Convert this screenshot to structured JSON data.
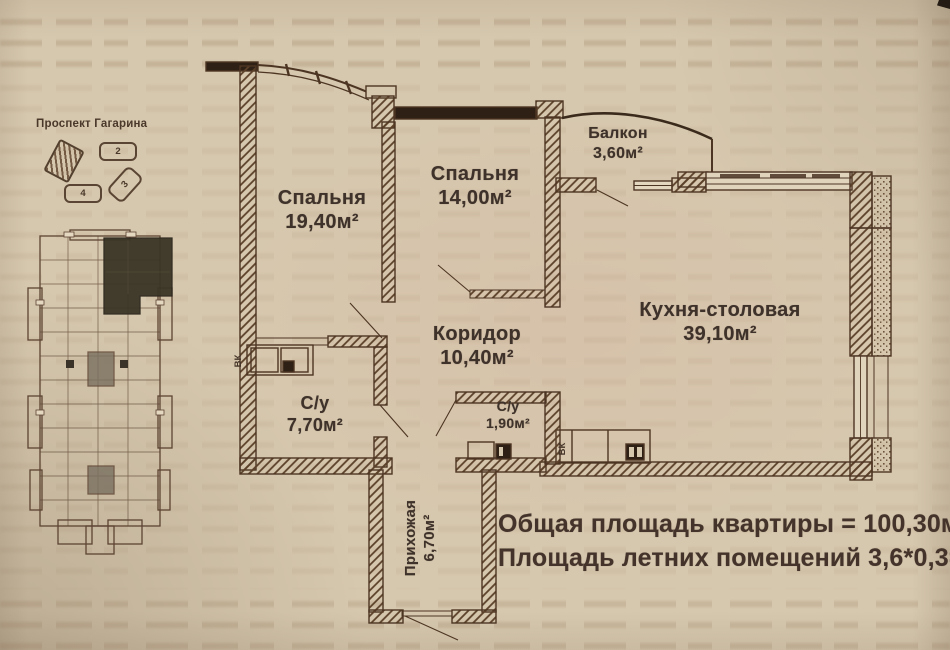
{
  "site": {
    "street_label": "Проспект Гагарина",
    "blocks": [
      {
        "num": "2"
      },
      {
        "num": "3"
      },
      {
        "num": "4"
      }
    ]
  },
  "rooms": {
    "bedroom1": {
      "name": "Спальня",
      "area": "19,40м²"
    },
    "bedroom2": {
      "name": "Спальня",
      "area": "14,00м²"
    },
    "balcony": {
      "name": "Балкон",
      "area": "3,60м²"
    },
    "kitchen": {
      "name": "Кухня-столовая",
      "area": "39,10м²"
    },
    "corridor": {
      "name": "Коридор",
      "area": "10,40м²"
    },
    "bathroom1": {
      "name": "С/у",
      "area": "7,70м²"
    },
    "bathroom2": {
      "name": "С/у",
      "area": "1,90м²"
    },
    "hallway": {
      "name": "Прихожая",
      "area": "6,70м²"
    }
  },
  "labels": {
    "shaft": "ВК"
  },
  "summary": {
    "line1": "Общая площадь квартиры = 100,30м",
    "line2": "Площадь летних помещений 3,6*0,3=1,"
  },
  "colors": {
    "paper": "#d6c8ae",
    "ink": "#4d3523",
    "dark_fill": "#2e2015"
  }
}
